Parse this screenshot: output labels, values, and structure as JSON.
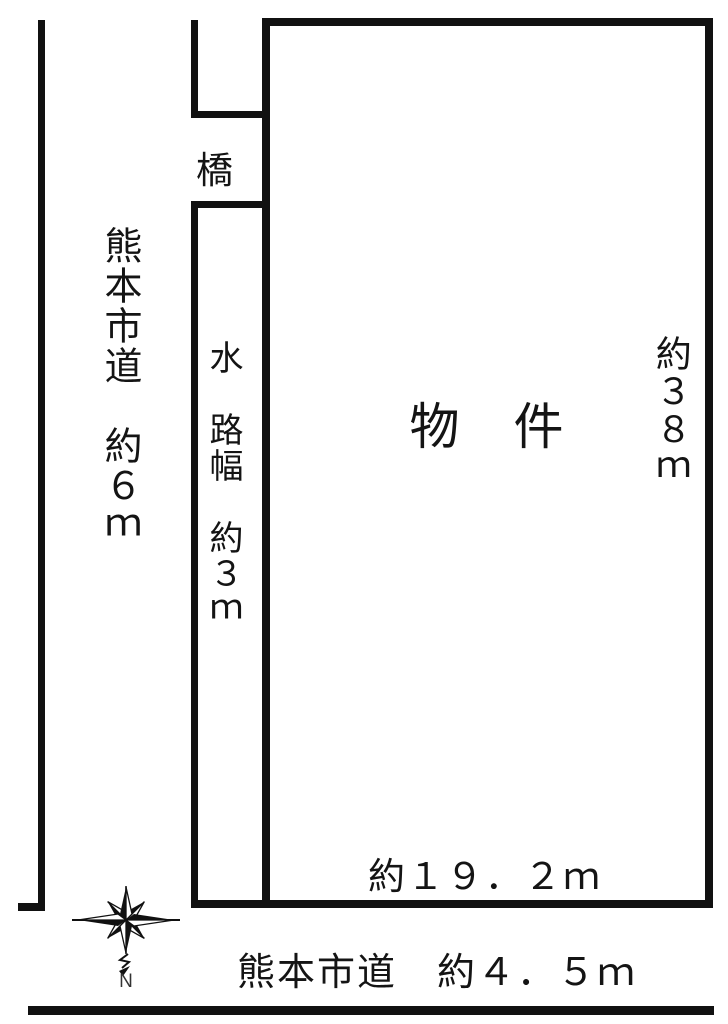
{
  "diagram": {
    "type": "land-plot-layout",
    "background_color": "#ffffff",
    "line_color": "#111111",
    "labels": {
      "left_road": "熊本市道　約６ｍ",
      "bridge": "橋",
      "waterway": "水　路幅　約３ｍ",
      "property": "物　件",
      "right_dim": "約３８ｍ",
      "bottom_dim": "約１９．２ｍ",
      "bottom_road": "熊本市道　約４．５ｍ",
      "compass_north": "N"
    }
  }
}
